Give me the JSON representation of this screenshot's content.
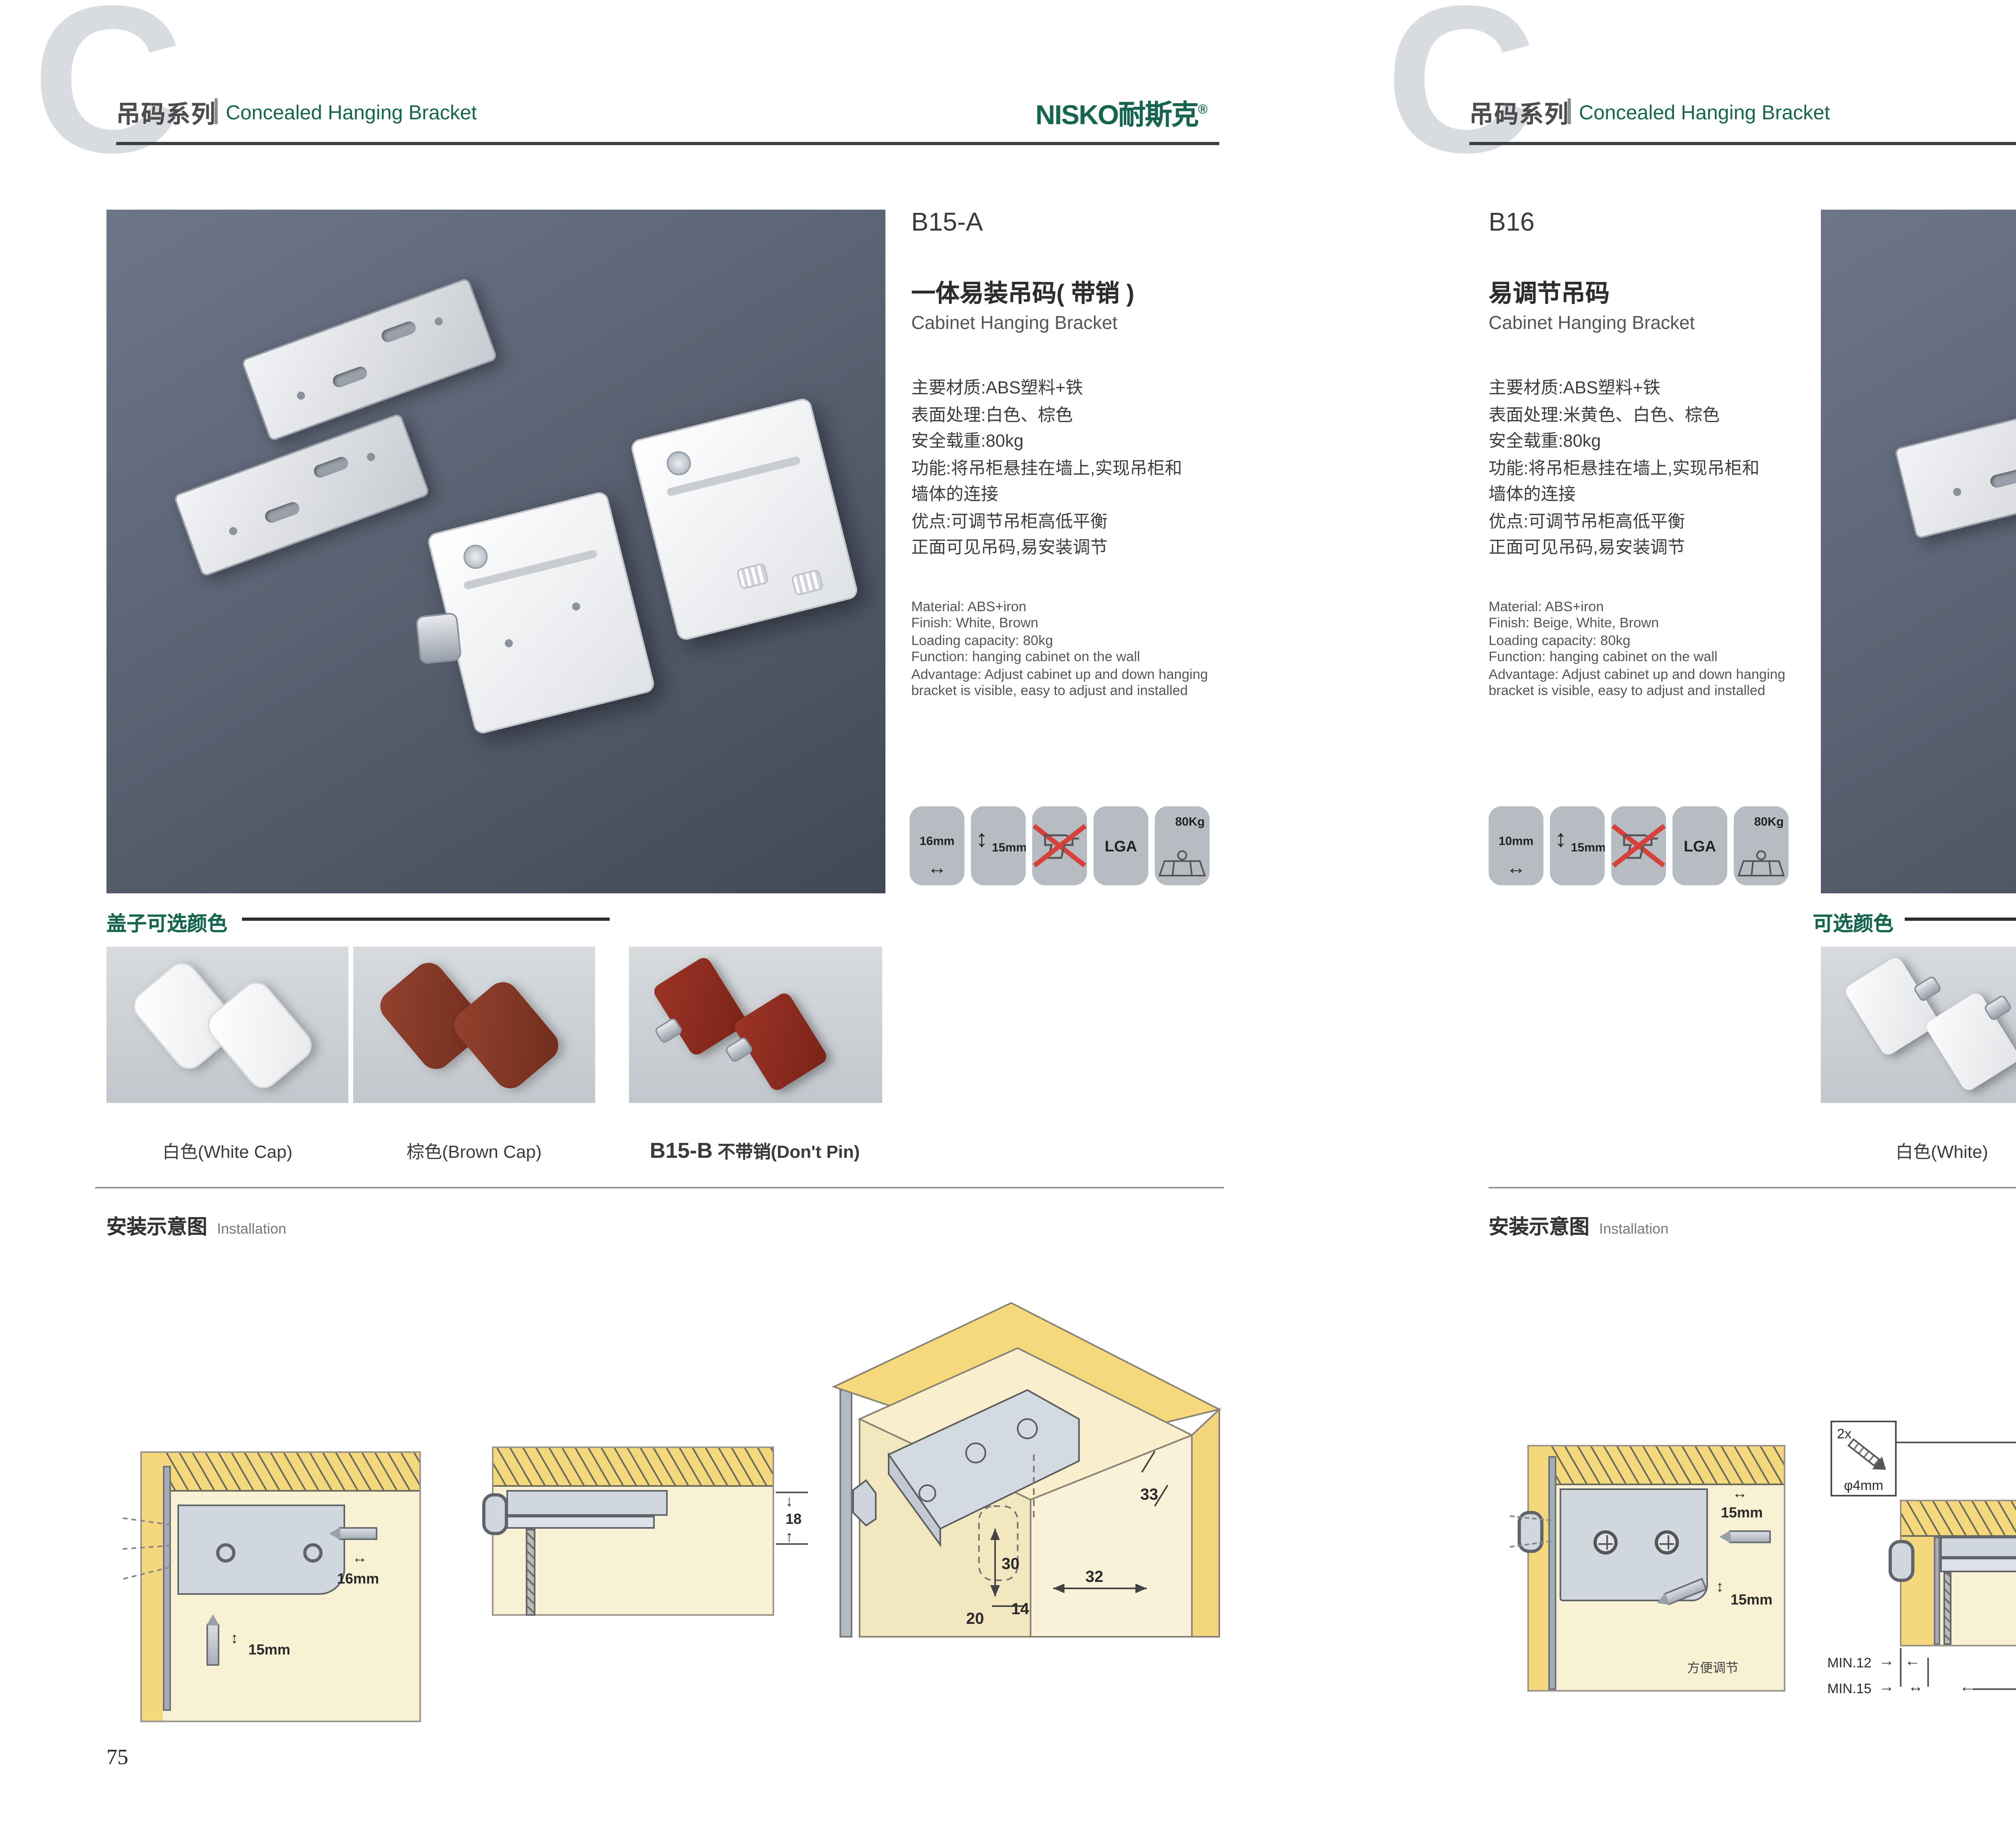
{
  "colors": {
    "accent_green": "#17654f",
    "photo_bg": "#565e6e",
    "wood_yellow": "#f5d87c",
    "panel_beige": "#f9f1d3",
    "tile_gray": "#b7bcc3"
  },
  "icon_glyphs": {
    "h_arrow": "↔",
    "v_arrow": "↕",
    "down": "↓",
    "up": "↑",
    "left": "←",
    "right": "→"
  },
  "header": {
    "series_zh": "吊码系列",
    "series_en": "Concealed Hanging Bracket",
    "brand_latin": "NISKO",
    "brand_zh": "耐斯克",
    "reg": "®",
    "watermark": "C"
  },
  "pages": [
    {
      "page_number": "75",
      "product": {
        "code": "B15-A",
        "name_zh": "一体易装吊码( 带销 )",
        "name_en": "Cabinet Hanging Bracket",
        "specs_zh": [
          "主要材质:ABS塑料+铁",
          "表面处理:白色、棕色",
          "安全载重:80kg",
          "功能:将吊柜悬挂在墙上,实现吊柜和",
          "墙体的连接",
          "优点:可调节吊柜高低平衡",
          "正面可见吊码,易安装调节"
        ],
        "specs_en": [
          "Material: ABS+iron",
          "Finish: White, Brown",
          "Loading capacity: 80kg",
          "Function: hanging cabinet on the wall",
          "Advantage: Adjust cabinet up and down hanging",
          "bracket is visible, easy to adjust and installed"
        ],
        "icons": {
          "dim_h": "16mm",
          "dim_v": "15mm",
          "cert": "LGA",
          "load": "80Kg"
        }
      },
      "colors_section": {
        "title": "盖子可选颜色",
        "swatch_labels": [
          "白色(White Cap)",
          "棕色(Brown Cap)"
        ],
        "variant_code": "B15-B",
        "variant_label": "不带销(Don't Pin)"
      },
      "installation": {
        "title_zh": "安装示意图",
        "title_en": "Installation",
        "d1": {
          "dim_h": "16mm",
          "dim_v": "15mm"
        },
        "d2": {
          "dim": "18"
        },
        "d3": {
          "dims": [
            "33",
            "30",
            "32",
            "20",
            "14"
          ]
        }
      }
    },
    {
      "page_number": "76",
      "product": {
        "code": "B16",
        "name_zh": "易调节吊码",
        "name_en": "Cabinet Hanging Bracket",
        "specs_zh": [
          "主要材质:ABS塑料+铁",
          "表面处理:米黄色、白色、棕色",
          "安全载重:80kg",
          "功能:将吊柜悬挂在墙上,实现吊柜和",
          "墙体的连接",
          "优点:可调节吊柜高低平衡",
          "正面可见吊码,易安装调节"
        ],
        "specs_en": [
          "Material: ABS+iron",
          "Finish: Beige, White, Brown",
          "Loading capacity: 80kg",
          "Function: hanging cabinet on the wall",
          "Advantage: Adjust cabinet up and down hanging",
          "bracket is visible, easy to adjust and installed"
        ],
        "icons": {
          "dim_h": "10mm",
          "dim_v": "15mm",
          "cert": "LGA",
          "load": "80Kg"
        }
      },
      "colors_section": {
        "title": "可选颜色",
        "swatch_labels": [
          "白色(White)",
          "棕色(Brown )",
          "米黄色 (Beige)"
        ]
      },
      "installation": {
        "title_zh": "安装示意图",
        "title_en": "Installation",
        "d1": {
          "dim_h": "15mm",
          "dim_v": "15mm",
          "note": "方便调节"
        },
        "screw_box": {
          "count": "2x",
          "dia": "φ4mm"
        },
        "d2": {
          "dim": "19",
          "min_a": "MIN.12",
          "min_b": "MIN.15"
        },
        "d3": {
          "dims": [
            "30",
            "32",
            "RMAX4",
            "19",
            "20",
            "32"
          ]
        }
      }
    }
  ]
}
